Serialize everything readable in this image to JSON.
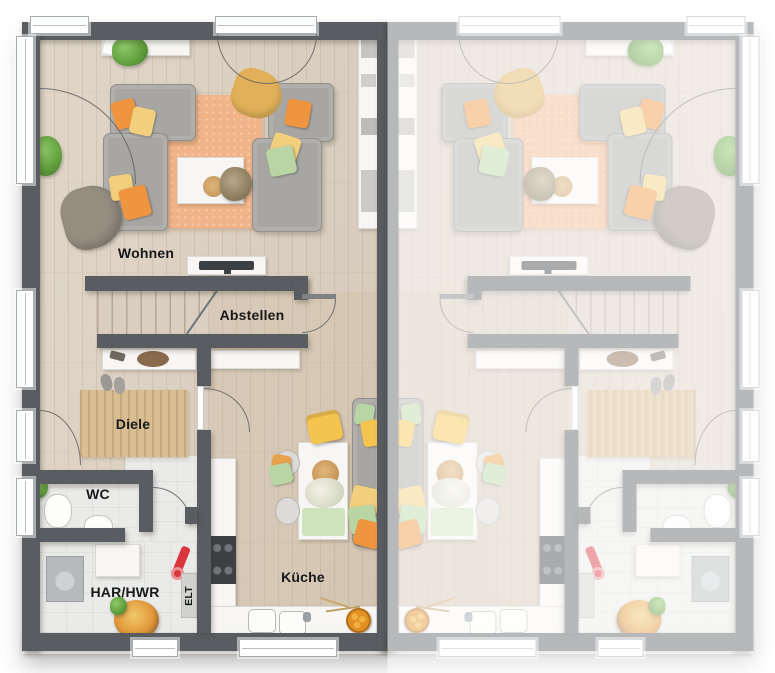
{
  "title": "Erdgeschoss Grundriss Doppelhaus",
  "labels": {
    "wohnen": "Wohnen",
    "abstellen": "Abstellen",
    "diele": "Diele",
    "wc": "WC",
    "har_hwr": "HAR/HWR",
    "elt": "ELT",
    "kueche": "Küche"
  },
  "palette": {
    "wall": "#595d61",
    "white-furniture": "#f7f6f4",
    "floor-wood": "#dcd1c3",
    "floor-tile": "#eaeae8",
    "rug-orange": "#f1b488",
    "rug-jute": "#d9bd93",
    "sofa-gray": "#a7a6a2",
    "pillow-orange": "#f0953f",
    "pillow-yellow": "#f2cf7d",
    "pillow-green": "#b9d5a4",
    "blanket-mustard": "#e0b159",
    "chair-yellow": "#f5c44f",
    "seat-green": "#cfe4bd",
    "plant-green": "#63a13f",
    "appliance-dark": "#3c4043",
    "accent-red": "#d9363e",
    "fruit-orange": "#e28f26",
    "fade-overlay": "rgba(255,255,255,0.56)"
  }
}
